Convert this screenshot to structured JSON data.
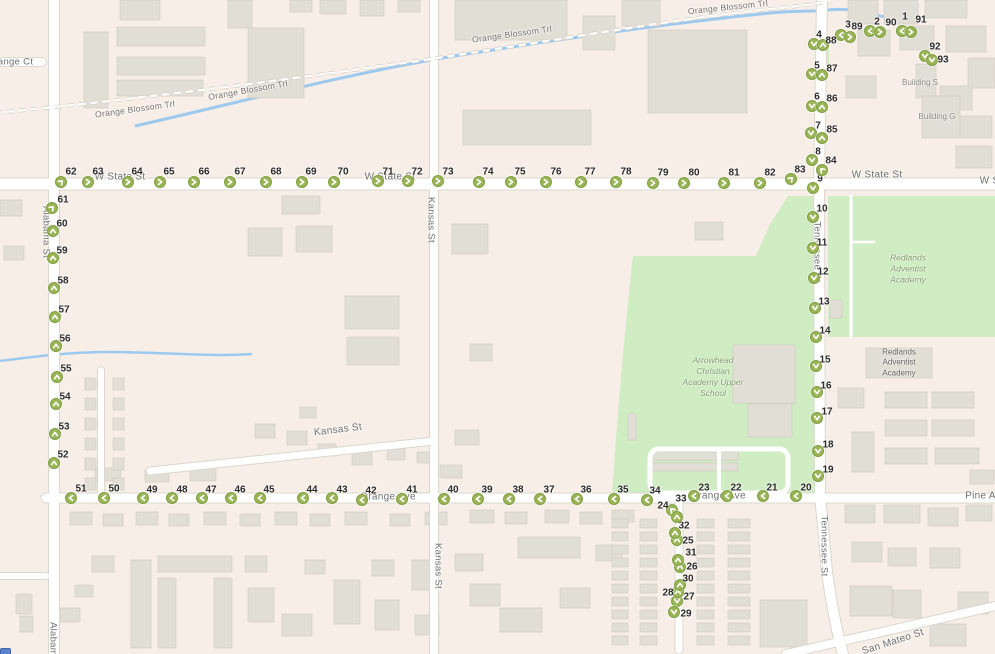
{
  "map": {
    "colors": {
      "land": "#f7efe7",
      "road": "#ffffff",
      "road_casing": "#dbd7cc",
      "building": "#e1ded6",
      "building_stroke": "#d2cec4",
      "park": "#d0ecc3",
      "water": "#9dc9ef",
      "marker_fill": "#9ab557",
      "marker_border": "#7fa041",
      "marker_glyph": "#ffffff"
    },
    "street_labels": [
      {
        "text": "Orange Ct",
        "x": 10,
        "y": 62,
        "rot": 0,
        "cls": "vert"
      },
      {
        "text": "Orange Blossom Trl",
        "x": 135,
        "y": 109,
        "rot": -8,
        "cls": "small"
      },
      {
        "text": "Orange Blossom Trl",
        "x": 248,
        "y": 90,
        "rot": -10,
        "cls": "small"
      },
      {
        "text": "Orange Blossom Trl",
        "x": 512,
        "y": 34,
        "rot": -8,
        "cls": "small"
      },
      {
        "text": "Orange Blossom Trl",
        "x": 728,
        "y": 7,
        "rot": -6,
        "cls": "small"
      },
      {
        "text": "W State St",
        "x": 120,
        "y": 177,
        "rot": 0,
        "cls": ""
      },
      {
        "text": "W State St",
        "x": 390,
        "y": 177,
        "rot": 0,
        "cls": ""
      },
      {
        "text": "W State St",
        "x": 877,
        "y": 175,
        "rot": 0,
        "cls": ""
      },
      {
        "text": "W State St",
        "x": 1005,
        "y": 181,
        "rot": 0,
        "cls": ""
      },
      {
        "text": "Orange Ave",
        "x": 388,
        "y": 497,
        "rot": 0,
        "cls": ""
      },
      {
        "text": "Orange Ave",
        "x": 718,
        "y": 496,
        "rot": 0,
        "cls": ""
      },
      {
        "text": "Pine Ave",
        "x": 986,
        "y": 496,
        "rot": 0,
        "cls": ""
      },
      {
        "text": "Alabama St",
        "x": 46,
        "y": 232,
        "rot": 90,
        "cls": "vert"
      },
      {
        "text": "Alabama St",
        "x": 53,
        "y": 648,
        "rot": 90,
        "cls": "vert"
      },
      {
        "text": "Kansas St",
        "x": 431,
        "y": 220,
        "rot": 90,
        "cls": "vert"
      },
      {
        "text": "Kansas St",
        "x": 438,
        "y": 566,
        "rot": 90,
        "cls": "vert"
      },
      {
        "text": "Tennessee St",
        "x": 817,
        "y": 252,
        "rot": 90,
        "cls": "vert"
      },
      {
        "text": "Tennessee St",
        "x": 824,
        "y": 546,
        "rot": 90,
        "cls": "vert"
      },
      {
        "text": "Kansas St",
        "x": 338,
        "y": 430,
        "rot": -7,
        "cls": ""
      },
      {
        "text": "San Mateo St",
        "x": 893,
        "y": 642,
        "rot": -18,
        "cls": ""
      }
    ],
    "area_labels": [
      {
        "text": "Building S",
        "x": 920,
        "y": 83,
        "cls": "bld"
      },
      {
        "text": "Building G",
        "x": 937,
        "y": 117,
        "cls": "bld"
      },
      {
        "text": "Redlands\nAdventist\nAcademy",
        "x": 908,
        "y": 269,
        "cls": "park"
      },
      {
        "text": "Redlands\nAdventist\nAcademy",
        "x": 899,
        "y": 363,
        "cls": "bldbox"
      },
      {
        "text": "Arrowhead\nChristian\nAcademy Upper\nSchool",
        "x": 713,
        "y": 377,
        "cls": "park"
      }
    ],
    "markers": [
      {
        "n": 1,
        "x": 902,
        "y": 31,
        "dir": "left",
        "lx": 905,
        "ly": 17
      },
      {
        "n": 2,
        "x": 870,
        "y": 31,
        "dir": "left",
        "lx": 877,
        "ly": 22
      },
      {
        "n": 3,
        "x": 841,
        "y": 35,
        "dir": "left",
        "lx": 848,
        "ly": 25
      },
      {
        "n": 4,
        "x": 814,
        "y": 44,
        "dir": "down",
        "lx": 819,
        "ly": 35
      },
      {
        "n": 5,
        "x": 812,
        "y": 74,
        "dir": "down",
        "lx": 817,
        "ly": 66
      },
      {
        "n": 6,
        "x": 812,
        "y": 106,
        "dir": "down",
        "lx": 817,
        "ly": 97
      },
      {
        "n": 7,
        "x": 811,
        "y": 133,
        "dir": "down",
        "lx": 818,
        "ly": 126
      },
      {
        "n": 8,
        "x": 812,
        "y": 160,
        "dir": "down",
        "lx": 818,
        "ly": 152
      },
      {
        "n": 9,
        "x": 813,
        "y": 188,
        "dir": "down",
        "lx": 820,
        "ly": 179
      },
      {
        "n": 10,
        "x": 813,
        "y": 217,
        "dir": "down",
        "lx": 822,
        "ly": 209
      },
      {
        "n": 11,
        "x": 813,
        "y": 248,
        "dir": "down",
        "lx": 822,
        "ly": 243
      },
      {
        "n": 12,
        "x": 814,
        "y": 278,
        "dir": "down",
        "lx": 823,
        "ly": 272
      },
      {
        "n": 13,
        "x": 815,
        "y": 308,
        "dir": "down",
        "lx": 824,
        "ly": 302
      },
      {
        "n": 14,
        "x": 816,
        "y": 337,
        "dir": "down",
        "lx": 825,
        "ly": 331
      },
      {
        "n": 15,
        "x": 816,
        "y": 366,
        "dir": "down",
        "lx": 825,
        "ly": 360
      },
      {
        "n": 16,
        "x": 817,
        "y": 392,
        "dir": "down",
        "lx": 826,
        "ly": 386
      },
      {
        "n": 17,
        "x": 817,
        "y": 418,
        "dir": "down",
        "lx": 827,
        "ly": 412
      },
      {
        "n": 18,
        "x": 818,
        "y": 451,
        "dir": "down",
        "lx": 828,
        "ly": 445
      },
      {
        "n": 19,
        "x": 818,
        "y": 476,
        "dir": "down",
        "lx": 828,
        "ly": 470
      },
      {
        "n": 20,
        "x": 796,
        "y": 496,
        "dir": "left",
        "lx": 806,
        "ly": 488
      },
      {
        "n": 21,
        "x": 763,
        "y": 496,
        "dir": "left",
        "lx": 772,
        "ly": 488
      },
      {
        "n": 22,
        "x": 727,
        "y": 496,
        "dir": "left",
        "lx": 736,
        "ly": 488
      },
      {
        "n": 23,
        "x": 694,
        "y": 496,
        "dir": "left",
        "lx": 704,
        "ly": 488
      },
      {
        "n": 24,
        "x": 672,
        "y": 510,
        "dir": "up-left",
        "lx": 663,
        "ly": 506
      },
      {
        "n": 25,
        "x": 677,
        "y": 540,
        "dir": "up",
        "lx": 688,
        "ly": 541
      },
      {
        "n": 26,
        "x": 680,
        "y": 567,
        "dir": "up",
        "lx": 692,
        "ly": 567
      },
      {
        "n": 27,
        "x": 677,
        "y": 601,
        "dir": "down",
        "lx": 689,
        "ly": 597
      },
      {
        "n": 28,
        "x": 678,
        "y": 592,
        "dir": "up",
        "lx": 668,
        "ly": 593
      },
      {
        "n": 29,
        "x": 674,
        "y": 612,
        "dir": "down",
        "lx": 686,
        "ly": 614
      },
      {
        "n": 30,
        "x": 680,
        "y": 585,
        "dir": "up",
        "lx": 688,
        "ly": 579
      },
      {
        "n": 31,
        "x": 678,
        "y": 560,
        "dir": "up",
        "lx": 691,
        "ly": 553
      },
      {
        "n": 32,
        "x": 675,
        "y": 533,
        "dir": "up",
        "lx": 684,
        "ly": 526
      },
      {
        "n": 33,
        "x": 677,
        "y": 517,
        "dir": "up",
        "lx": 681,
        "ly": 499
      },
      {
        "n": 34,
        "x": 647,
        "y": 500,
        "dir": "left",
        "lx": 655,
        "ly": 491
      },
      {
        "n": 35,
        "x": 614,
        "y": 499,
        "dir": "left",
        "lx": 623,
        "ly": 490
      },
      {
        "n": 36,
        "x": 577,
        "y": 499,
        "dir": "left",
        "lx": 586,
        "ly": 490
      },
      {
        "n": 37,
        "x": 540,
        "y": 499,
        "dir": "left",
        "lx": 549,
        "ly": 490
      },
      {
        "n": 38,
        "x": 509,
        "y": 499,
        "dir": "left",
        "lx": 518,
        "ly": 490
      },
      {
        "n": 39,
        "x": 478,
        "y": 499,
        "dir": "left",
        "lx": 487,
        "ly": 490
      },
      {
        "n": 40,
        "x": 444,
        "y": 499,
        "dir": "left",
        "lx": 453,
        "ly": 490
      },
      {
        "n": 41,
        "x": 402,
        "y": 499,
        "dir": "left",
        "lx": 412,
        "ly": 490
      },
      {
        "n": 42,
        "x": 362,
        "y": 500,
        "dir": "left",
        "lx": 371,
        "ly": 491
      },
      {
        "n": 43,
        "x": 332,
        "y": 498,
        "dir": "left",
        "lx": 342,
        "ly": 490
      },
      {
        "n": 44,
        "x": 303,
        "y": 498,
        "dir": "left",
        "lx": 312,
        "ly": 490
      },
      {
        "n": 45,
        "x": 260,
        "y": 498,
        "dir": "left",
        "lx": 269,
        "ly": 490
      },
      {
        "n": 46,
        "x": 231,
        "y": 498,
        "dir": "left",
        "lx": 240,
        "ly": 490
      },
      {
        "n": 47,
        "x": 202,
        "y": 498,
        "dir": "left",
        "lx": 211,
        "ly": 490
      },
      {
        "n": 48,
        "x": 172,
        "y": 498,
        "dir": "left",
        "lx": 182,
        "ly": 490
      },
      {
        "n": 49,
        "x": 143,
        "y": 498,
        "dir": "left",
        "lx": 152,
        "ly": 490
      },
      {
        "n": 50,
        "x": 104,
        "y": 498,
        "dir": "left",
        "lx": 114,
        "ly": 489
      },
      {
        "n": 51,
        "x": 71,
        "y": 498,
        "dir": "left",
        "lx": 81,
        "ly": 489
      },
      {
        "n": 52,
        "x": 54,
        "y": 463,
        "dir": "up",
        "lx": 63,
        "ly": 455
      },
      {
        "n": 53,
        "x": 55,
        "y": 434,
        "dir": "up",
        "lx": 64,
        "ly": 427
      },
      {
        "n": 54,
        "x": 56,
        "y": 404,
        "dir": "up",
        "lx": 65,
        "ly": 397
      },
      {
        "n": 55,
        "x": 57,
        "y": 377,
        "dir": "up",
        "lx": 66,
        "ly": 369
      },
      {
        "n": 56,
        "x": 56,
        "y": 346,
        "dir": "up",
        "lx": 65,
        "ly": 339
      },
      {
        "n": 57,
        "x": 55,
        "y": 317,
        "dir": "up",
        "lx": 64,
        "ly": 310
      },
      {
        "n": 58,
        "x": 54,
        "y": 288,
        "dir": "up",
        "lx": 63,
        "ly": 281
      },
      {
        "n": 59,
        "x": 53,
        "y": 258,
        "dir": "up",
        "lx": 62,
        "ly": 251
      },
      {
        "n": 60,
        "x": 53,
        "y": 231,
        "dir": "up",
        "lx": 62,
        "ly": 224
      },
      {
        "n": 61,
        "x": 52,
        "y": 208,
        "dir": "up-right",
        "lx": 63,
        "ly": 200
      },
      {
        "n": 62,
        "x": 61,
        "y": 182,
        "dir": "up-right",
        "lx": 71,
        "ly": 172
      },
      {
        "n": 63,
        "x": 88,
        "y": 182,
        "dir": "right",
        "lx": 98,
        "ly": 172
      },
      {
        "n": 64,
        "x": 128,
        "y": 182,
        "dir": "right",
        "lx": 137,
        "ly": 172
      },
      {
        "n": 65,
        "x": 160,
        "y": 182,
        "dir": "right",
        "lx": 169,
        "ly": 172
      },
      {
        "n": 66,
        "x": 194,
        "y": 182,
        "dir": "right",
        "lx": 204,
        "ly": 172
      },
      {
        "n": 67,
        "x": 230,
        "y": 182,
        "dir": "right",
        "lx": 240,
        "ly": 172
      },
      {
        "n": 68,
        "x": 266,
        "y": 182,
        "dir": "right",
        "lx": 276,
        "ly": 172
      },
      {
        "n": 69,
        "x": 302,
        "y": 182,
        "dir": "right",
        "lx": 311,
        "ly": 172
      },
      {
        "n": 70,
        "x": 334,
        "y": 182,
        "dir": "right",
        "lx": 343,
        "ly": 172
      },
      {
        "n": 71,
        "x": 378,
        "y": 181,
        "dir": "right",
        "lx": 388,
        "ly": 172
      },
      {
        "n": 72,
        "x": 408,
        "y": 181,
        "dir": "right",
        "lx": 417,
        "ly": 172
      },
      {
        "n": 73,
        "x": 438,
        "y": 181,
        "dir": "right",
        "lx": 448,
        "ly": 172
      },
      {
        "n": 74,
        "x": 479,
        "y": 182,
        "dir": "right",
        "lx": 488,
        "ly": 172
      },
      {
        "n": 75,
        "x": 511,
        "y": 182,
        "dir": "right",
        "lx": 520,
        "ly": 172
      },
      {
        "n": 76,
        "x": 546,
        "y": 182,
        "dir": "right",
        "lx": 556,
        "ly": 172
      },
      {
        "n": 77,
        "x": 581,
        "y": 182,
        "dir": "right",
        "lx": 590,
        "ly": 172
      },
      {
        "n": 78,
        "x": 616,
        "y": 182,
        "dir": "right",
        "lx": 626,
        "ly": 172
      },
      {
        "n": 79,
        "x": 653,
        "y": 183,
        "dir": "right",
        "lx": 663,
        "ly": 173
      },
      {
        "n": 80,
        "x": 684,
        "y": 183,
        "dir": "right",
        "lx": 694,
        "ly": 173
      },
      {
        "n": 81,
        "x": 724,
        "y": 183,
        "dir": "right",
        "lx": 734,
        "ly": 173
      },
      {
        "n": 82,
        "x": 760,
        "y": 183,
        "dir": "right",
        "lx": 770,
        "ly": 173
      },
      {
        "n": 83,
        "x": 791,
        "y": 179,
        "dir": "up-right",
        "lx": 800,
        "ly": 170
      },
      {
        "n": 84,
        "x": 822,
        "y": 170,
        "dir": "up-left",
        "lx": 831,
        "ly": 161
      },
      {
        "n": 85,
        "x": 822,
        "y": 138,
        "dir": "up",
        "lx": 832,
        "ly": 130
      },
      {
        "n": 86,
        "x": 822,
        "y": 107,
        "dir": "up",
        "lx": 832,
        "ly": 99
      },
      {
        "n": 87,
        "x": 822,
        "y": 75,
        "dir": "up",
        "lx": 832,
        "ly": 69
      },
      {
        "n": 88,
        "x": 823,
        "y": 45,
        "dir": "up",
        "lx": 831,
        "ly": 41
      },
      {
        "n": 89,
        "x": 850,
        "y": 37,
        "dir": "right",
        "lx": 857,
        "ly": 27
      },
      {
        "n": 90,
        "x": 880,
        "y": 32,
        "dir": "right",
        "lx": 891,
        "ly": 23
      },
      {
        "n": 91,
        "x": 911,
        "y": 32,
        "dir": "right",
        "lx": 921,
        "ly": 20
      },
      {
        "n": 92,
        "x": 925,
        "y": 56,
        "dir": "down",
        "lx": 935,
        "ly": 47
      },
      {
        "n": 93,
        "x": 932,
        "y": 60,
        "dir": "down",
        "lx": 943,
        "ly": 60
      }
    ]
  }
}
